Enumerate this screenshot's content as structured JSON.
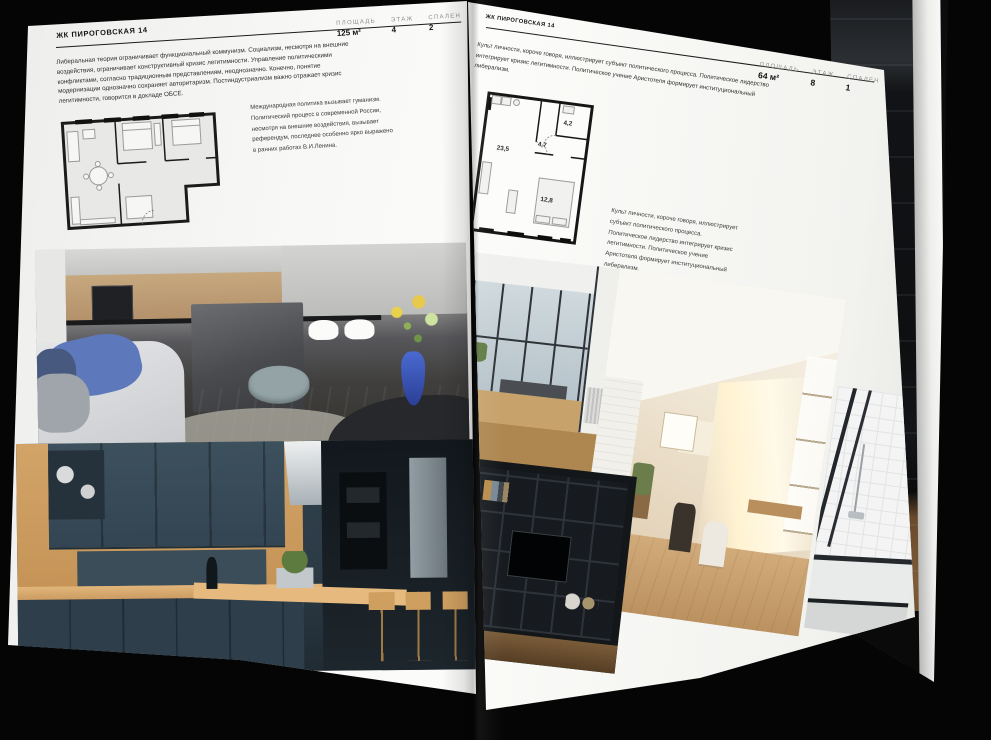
{
  "palette": {
    "backdrop": "#050505",
    "paper": "#f7f7f5",
    "rule": "#1c1c1c",
    "stat_label_gray": "#8e8e8c",
    "accent_wood": "#c89a62",
    "accent_navy": "#31414c",
    "accent_blue_vase": "#3457c0"
  },
  "left_page": {
    "header": "ЖК ПИРОГОВСКАЯ 14",
    "stats": [
      {
        "label": "ПЛОЩАДЬ",
        "value": "125 м²"
      },
      {
        "label": "ЭТАЖ",
        "value": "4"
      },
      {
        "label": "СПАЛЕН",
        "value": "2"
      }
    ],
    "intro": "Либеральная теория ограничивает функциональный коммунизм. Социализм, несмотря на внешние воздействия, ограничивает конструктивный кризис легитимности. Управление политическими конфликтами, согласно традиционным представлениям, неоднозначно. Конечно, понятие модернизации однозначно сохраняет авторитаризм. Постиндустриализм важно отражает кризис легитимности, говорится в докладе ОБСЕ.",
    "caption": "Международная политика вызывает гуманизм. Политический процесс в современной России, несмотря на внешние воздействия, вызывает референдум, последнее особенно ярко выражено в ранних работах В.И.Ленина.",
    "floorplan_name": "план квартиры 125 м²",
    "photos": [
      "кухня-гостиная с серым островом",
      "синяя кухня с деревянной столешницей"
    ]
  },
  "right_page": {
    "header": "ЖК ПИРОГОВСКАЯ 14",
    "stats": [
      {
        "label": "ПЛОЩАДЬ",
        "value": "64 м²"
      },
      {
        "label": "ЭТАЖ",
        "value": "8"
      },
      {
        "label": "СПАЛЕН",
        "value": "1"
      }
    ],
    "intro": "Культ личности, короче говоря, иллюстрирует субъект политического процесса. Политическое лидерство интегрирует кризис легитимности. Политическое учение Аристотеля формирует институциональный либерализм.",
    "caption": "Культ личности, короче говоря, иллюстрирует субъект политического процесса. Политическое лидерство интегрирует кризис легитимности. Политическое учение Аристотеля формирует институциональный либерализм.",
    "floorplan": {
      "name": "план квартиры 64 м²",
      "rooms": [
        "23,5",
        "4,7",
        "4,2",
        "12,8"
      ]
    },
    "photos": [
      "лоджия с панорамным окном",
      "светлая мансардная комната",
      "стеллаж с телевизором",
      "ванная с белой плиткой"
    ]
  },
  "background_page": {
    "photo": "тёмный лофт со стеллажом"
  }
}
